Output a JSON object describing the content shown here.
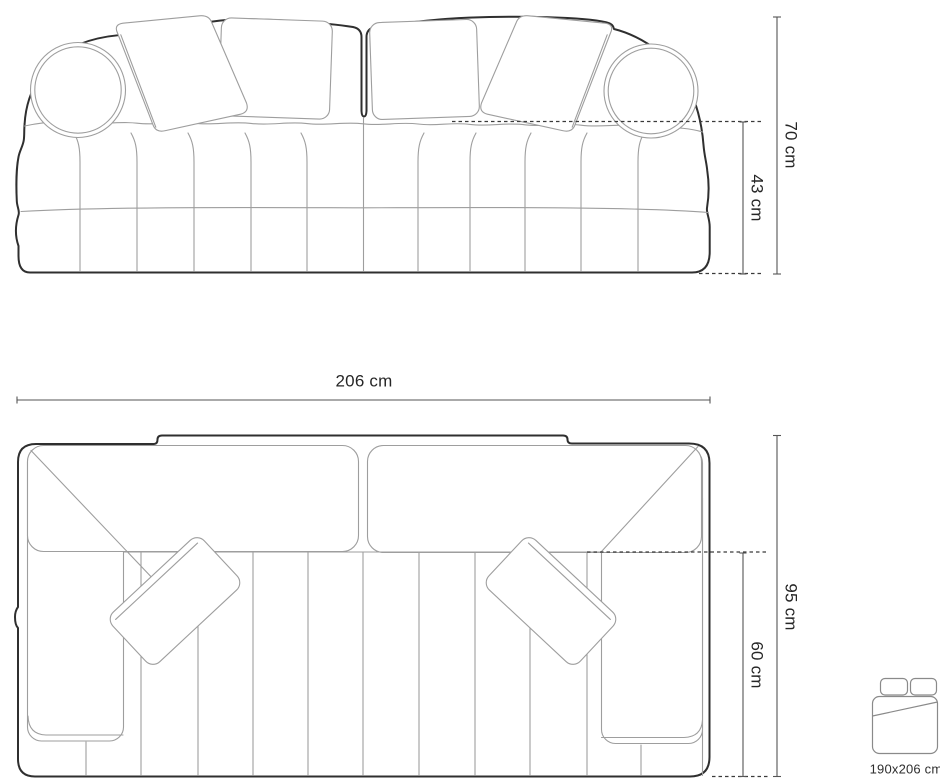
{
  "diagram": {
    "front_view": {
      "height_label": "70 cm",
      "seat_height_label": "43 cm"
    },
    "top_view": {
      "width_label": "206 cm",
      "depth_label": "95 cm",
      "seat_depth_label": "60 cm"
    },
    "sleeping_area": {
      "icon": "sofa-bed-top-view-icon",
      "label": "190x206 cm"
    }
  },
  "colors": {
    "background": "#ffffff",
    "outline": "#2f2f2f",
    "detail_line": "#9e9e9e",
    "dimension_line": "#555555",
    "dashed_line": "#3a3a3a",
    "text": "#262626"
  }
}
